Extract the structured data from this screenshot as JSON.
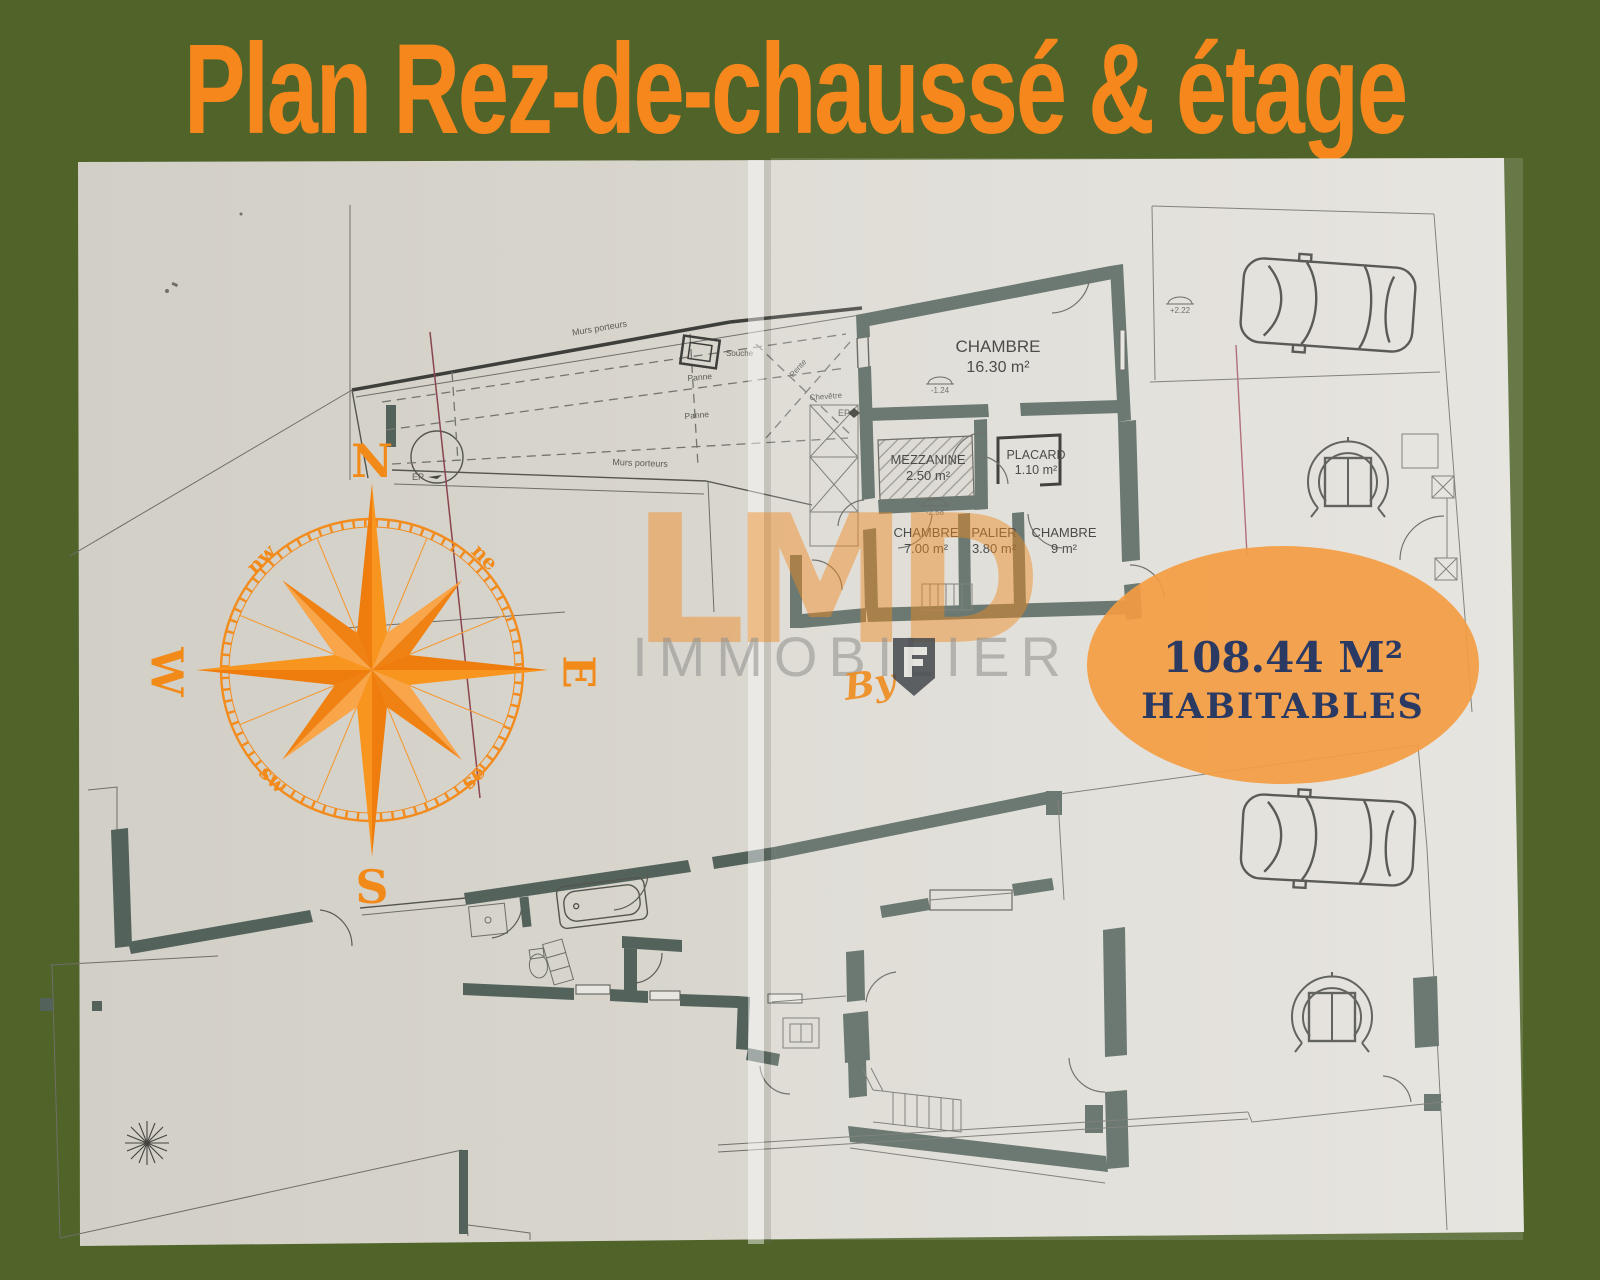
{
  "header": {
    "title": "Plan Rez-de-chaussé & étage"
  },
  "paper": {
    "badge": {
      "area": "108.44 M²",
      "label": "HABITABLES"
    },
    "compass": {
      "north": "N",
      "south": "S",
      "east": "E",
      "west": "W",
      "northwest": "nw",
      "northeast": "ne",
      "southwest": "sw",
      "southeast": "se"
    },
    "watermark": {
      "brand": "LMD",
      "word": "IMMOBILIER",
      "by": "By"
    },
    "etage": {
      "rooms": [
        {
          "name": "CHAMBRE",
          "area": "16.30 m²"
        },
        {
          "name": "MEZZANINE",
          "area": "2.50 m²"
        },
        {
          "name": "PLACARD",
          "area": "1.10 m²"
        },
        {
          "name": "CHAMBRE",
          "area": "7.00 m²"
        },
        {
          "name": "PALIER",
          "area": "3.80 m²"
        },
        {
          "name": "CHAMBRE",
          "area": "9 m²"
        }
      ],
      "labels": {
        "murs_porteurs_top": "Murs porteurs",
        "murs_porteurs_bottom": "Murs porteurs",
        "panne_1": "Panne",
        "panne_2": "Panne",
        "souche": "Souche",
        "chevetre": "Chevêtre",
        "pente": "Pente",
        "ep_1": "EP",
        "ep_2": "EP"
      },
      "levels": {
        "courtyard": "+2.22",
        "chambre": "-1.24",
        "mezzanine": "-2.58"
      }
    }
  }
}
